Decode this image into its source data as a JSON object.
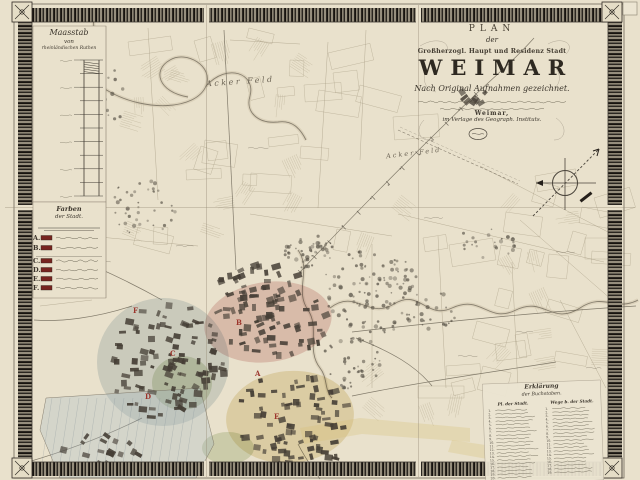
{
  "colors": {
    "parchment": "#e9e1cc",
    "border_ink": "#17130f",
    "map_ink": "#6e6657",
    "city_block": "#453e35",
    "district_pink": "#d08c8c",
    "district_blue": "#a4b9c6",
    "district_yellow": "#d6c178",
    "district_green": "#a9bc8c",
    "letter_red": "#9c352c",
    "swatch_red": "#77241f"
  },
  "title_block": {
    "plan_label": "PLAN",
    "der_label": "der",
    "dedication": "Großherzogl. Haupt und Residenz Stadt",
    "city_name": "WEIMAR",
    "subtitle": "Nach Original Aufnahmen gezeichnet.",
    "imprint_city": "Weimar,",
    "imprint_publisher": "im Verlage des Geograph. Instituts."
  },
  "scale_panel": {
    "title": "Maasstab",
    "prefix": "von",
    "unit": "rheinländischen Ruthen"
  },
  "district_legend": {
    "title_line1": "Farben",
    "title_line2": "der Stadt.",
    "entries": [
      {
        "letter": "A."
      },
      {
        "letter": "B."
      },
      {
        "letter": "C."
      },
      {
        "letter": "D."
      },
      {
        "letter": "E."
      },
      {
        "letter": "F."
      }
    ]
  },
  "map_labels": {
    "field_upper": "Acker Feld",
    "field_right": "Acker Feld"
  },
  "map_letters": [
    {
      "ch": "F"
    },
    {
      "ch": "B"
    },
    {
      "ch": "A"
    },
    {
      "ch": "C"
    },
    {
      "ch": "D"
    },
    {
      "ch": "E"
    }
  ],
  "letters_legend": {
    "title": "Erklärung",
    "subtitle": "der Buchstaben.",
    "col1_header": "Pl. der Stadt.",
    "col2_header": "Wege b. der Stadt.",
    "col1_rows": 20,
    "col2_rows": 19
  }
}
